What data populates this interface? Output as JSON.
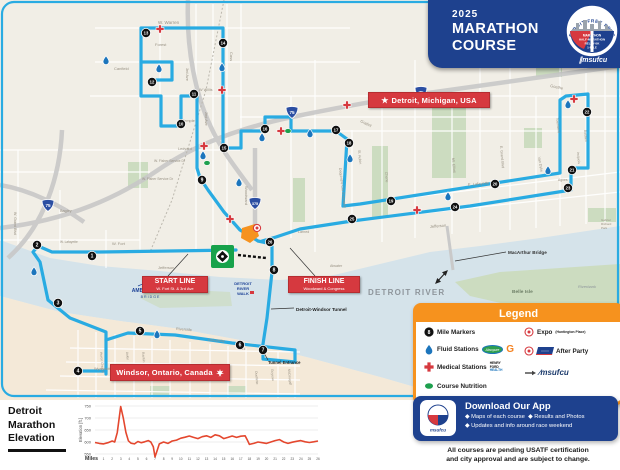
{
  "header": {
    "year": "2025",
    "title1": "MARATHON",
    "title2": "COURSE",
    "badge_arc": "DETROIT FREE PRESS",
    "badge_lines": [
      "MARATHON",
      "HALF-MARATHON",
      "RELAY•5K",
      "1-MILE"
    ],
    "sponsor": "msufcu"
  },
  "map": {
    "colors": {
      "course": "#29abe2",
      "river": "#d5e3ea",
      "land": "#f1eee6",
      "windsor_land": "#f4e9d8",
      "park": "#ccdcc0",
      "red": "#d6393f",
      "navy": "#1e418e",
      "orange": "#f6921e",
      "fluid": "#1c75bc",
      "nutrition": "#1ea04e",
      "elevation_line": "#e4472e"
    },
    "labels": {
      "detroit": "Detroit, Michigan, USA",
      "windsor": "Windsor, Ontario, Canada",
      "start_title": "START LINE",
      "start_sub": "W. Fort St. & 3rd Ave",
      "finish_title": "FINISH LINE",
      "finish_sub": "Woodward & Congress",
      "tunnel": "Detroit-Windsor Tunnel",
      "tunnel_entrance": "Tunnel Entrance",
      "macarthur": "MacArthur Bridge",
      "detroit_river": "DETROIT RIVER",
      "belle_isle": "Belle Isle",
      "riverbank": "Riverbank",
      "ambassador1": "AMBASSADOR",
      "ambassador2": "B R I D G E",
      "riverwalk": [
        "DETROIT",
        "RIVER",
        "WALK"
      ]
    },
    "shields": [
      {
        "t": "75",
        "x": 48,
        "y": 205
      },
      {
        "t": "75",
        "x": 292,
        "y": 112
      },
      {
        "t": "75",
        "x": 421,
        "y": 92
      },
      {
        "t": "375",
        "x": 255,
        "y": 203
      }
    ],
    "street_labels": [
      [
        "W. Warren",
        158,
        24,
        0,
        4.5
      ],
      [
        "Forest",
        155,
        46,
        0,
        4
      ],
      [
        "Canfield",
        114,
        70,
        0,
        4
      ],
      [
        "W Willis",
        199,
        91,
        0,
        3.8
      ],
      [
        "Temple",
        182,
        122,
        0,
        4
      ],
      [
        "Ledyard",
        178,
        150,
        0,
        3.8
      ],
      [
        "W. Fisher Service Dr",
        154,
        162,
        0,
        3.4
      ],
      [
        "W. Fisher Service Dr",
        142,
        180,
        0,
        3.4
      ],
      [
        "Cass",
        230,
        52,
        90,
        4
      ],
      [
        "2nd Ave",
        205,
        112,
        90,
        3.8
      ],
      [
        "3rd Ave",
        186,
        68,
        90,
        3.8
      ],
      [
        "Woodward",
        245,
        186,
        90,
        4
      ],
      [
        "Gratiot",
        360,
        122,
        25,
        4
      ],
      [
        "Dequindre Cut Greenway",
        339,
        168,
        83,
        3.6
      ],
      [
        "St. Aubin",
        358,
        150,
        85,
        3.6
      ],
      [
        "Chene",
        385,
        172,
        85,
        3.6
      ],
      [
        "Mt. Elliott",
        452,
        158,
        85,
        3.6
      ],
      [
        "E. Lafayette",
        468,
        186,
        -5,
        4
      ],
      [
        "Jefferson",
        430,
        228,
        -5,
        4
      ],
      [
        "Jefferson",
        158,
        269,
        0,
        4
      ],
      [
        "W. Fort",
        112,
        245,
        0,
        4
      ],
      [
        "W. Lafayette",
        60,
        243,
        0,
        3.2
      ],
      [
        "Bagley",
        60,
        212,
        0,
        3.8
      ],
      [
        "W. Grand Blvd",
        14,
        212,
        90,
        3.6
      ],
      [
        "E. Grand Blvd",
        500,
        146,
        85,
        3.6
      ],
      [
        "Van Dyke",
        538,
        157,
        80,
        3.6
      ],
      [
        "Townsend",
        556,
        118,
        83,
        3.4
      ],
      [
        "Baldwin",
        584,
        130,
        85,
        3.4
      ],
      [
        "Iroquois",
        577,
        152,
        85,
        3.4
      ],
      [
        "Agnes",
        558,
        181,
        0,
        3.4
      ],
      [
        "Goethe",
        550,
        87,
        12,
        4
      ],
      [
        "Atwater",
        330,
        267,
        0,
        3.6
      ],
      [
        "Larned",
        298,
        233,
        0,
        3.6
      ],
      [
        "Riverside",
        176,
        330,
        4,
        3.8
      ],
      [
        "Huron Church",
        100,
        352,
        85,
        3.4
      ],
      [
        "Askin",
        126,
        352,
        85,
        3.4
      ],
      [
        "Rankin",
        142,
        352,
        85,
        3.4
      ],
      [
        "University",
        208,
        341,
        4,
        3.8
      ],
      [
        "Park",
        238,
        350,
        0,
        3.6
      ],
      [
        "Wyandotte",
        94,
        370,
        0,
        3.8
      ],
      [
        "Ouellette",
        255,
        371,
        85,
        3.4
      ],
      [
        "Goyeau",
        271,
        369,
        85,
        3.4
      ],
      [
        "McDougall",
        288,
        369,
        85,
        3.4
      ],
      [
        "Gabriel",
        601,
        221,
        0,
        3
      ],
      [
        "Richard",
        601,
        225,
        0,
        3
      ],
      [
        "Park",
        601,
        229,
        0,
        3
      ]
    ],
    "mile_markers": [
      [
        1,
        92,
        256
      ],
      [
        2,
        37,
        245
      ],
      [
        3,
        58,
        303
      ],
      [
        4,
        78,
        371
      ],
      [
        5,
        140,
        331
      ],
      [
        6,
        240,
        345
      ],
      [
        7,
        263,
        350
      ],
      [
        8,
        274,
        270
      ],
      [
        9,
        202,
        180
      ],
      [
        10,
        181,
        124
      ],
      [
        11,
        194,
        94
      ],
      [
        12,
        152,
        82
      ],
      [
        13,
        146,
        33
      ],
      [
        14,
        223,
        43
      ],
      [
        15,
        224,
        148
      ],
      [
        16,
        265,
        129
      ],
      [
        17,
        336,
        130
      ],
      [
        18,
        349,
        143
      ],
      [
        19,
        391,
        201
      ],
      [
        20,
        495,
        184
      ],
      [
        21,
        572,
        170
      ],
      [
        22,
        587,
        112
      ],
      [
        23,
        568,
        188
      ],
      [
        24,
        455,
        207
      ],
      [
        25,
        352,
        219
      ],
      [
        26,
        270,
        242
      ]
    ],
    "fluid_stations": [
      [
        34,
        271
      ],
      [
        106,
        60
      ],
      [
        159,
        68
      ],
      [
        222,
        67
      ],
      [
        203,
        155
      ],
      [
        262,
        137
      ],
      [
        310,
        133
      ],
      [
        239,
        182
      ],
      [
        350,
        158
      ],
      [
        448,
        196
      ],
      [
        548,
        170
      ],
      [
        568,
        104
      ],
      [
        157,
        334
      ]
    ],
    "medical_stations": [
      [
        160,
        29
      ],
      [
        222,
        90
      ],
      [
        204,
        146
      ],
      [
        281,
        131
      ],
      [
        347,
        105
      ],
      [
        417,
        210
      ],
      [
        574,
        99
      ],
      [
        230,
        219
      ]
    ],
    "nutrition_stations": [
      [
        288,
        131
      ],
      [
        207,
        163
      ]
    ],
    "expo_points": [
      [
        257,
        228
      ]
    ]
  },
  "legend": {
    "title": "Legend",
    "mile_markers": "Mile Markers",
    "fluid": "Fluid Stations",
    "medical": "Medical Stations",
    "nutrition": "Course Nutrition",
    "expo": "Expo",
    "expo_sub": "(Huntington Place)",
    "after_party": "After Party",
    "henry_ford": [
      "HENRY",
      "FORD",
      "HEALTH"
    ],
    "absopure": "Absopure",
    "gatorade": "G",
    "sponsor": "msufcu",
    "sample_mile": "8"
  },
  "download": {
    "title": "Download Our App",
    "bullets": [
      "◆ Maps of each course",
      "◆ Results and Photos",
      "◆ Updates and info around race weekend"
    ]
  },
  "disclaimer": [
    "All courses are pending USATF certification",
    "and city approval and are subject to change."
  ],
  "elevation": {
    "title": [
      "Detroit",
      "Marathon",
      "Elevation"
    ],
    "ylabel": "Elevation [ft.]",
    "xlabel": "Miles"
  },
  "chart_data": {
    "type": "line",
    "title": "Detroit Marathon Elevation",
    "xlabel": "Miles",
    "ylabel": "Elevation [ft.]",
    "xlim": [
      0,
      26
    ],
    "ylim": [
      530,
      760
    ],
    "yticks": [
      550,
      600,
      650,
      700,
      750
    ],
    "xticks": [
      1,
      2,
      3,
      4,
      5,
      6,
      7,
      8,
      9,
      10,
      11,
      12,
      13,
      14,
      15,
      16,
      17,
      18,
      19,
      20,
      21,
      22,
      23,
      24,
      25,
      26
    ],
    "grid": true,
    "line_color": "#e4472e",
    "x": [
      0,
      0.5,
      1,
      1.5,
      2,
      2.3,
      2.6,
      3,
      3.3,
      3.6,
      3.9,
      4.2,
      4.6,
      5,
      5.4,
      5.8,
      6.2,
      6.5,
      6.8,
      7,
      7.2,
      7.5,
      8,
      8.5,
      9,
      9.5,
      10,
      10.5,
      11,
      11.5,
      12,
      12.5,
      13,
      13.5,
      14,
      14.5,
      15,
      15.5,
      16,
      16.5,
      17,
      17.5,
      17.8,
      18,
      18.5,
      19,
      19.5,
      20,
      20.5,
      21,
      21.5,
      22,
      22.5,
      23,
      23.5,
      24,
      24.5,
      25,
      25.5,
      26
    ],
    "y": [
      598,
      594,
      592,
      597,
      604,
      600,
      640,
      748,
      700,
      640,
      605,
      595,
      592,
      602,
      597,
      601,
      606,
      600,
      580,
      538,
      560,
      592,
      600,
      594,
      604,
      608,
      616,
      620,
      625,
      619,
      614,
      622,
      626,
      619,
      630,
      626,
      614,
      619,
      625,
      619,
      624,
      626,
      605,
      590,
      594,
      600,
      597,
      594,
      600,
      606,
      610,
      600,
      594,
      599,
      603,
      606,
      601,
      598,
      601,
      604
    ]
  }
}
